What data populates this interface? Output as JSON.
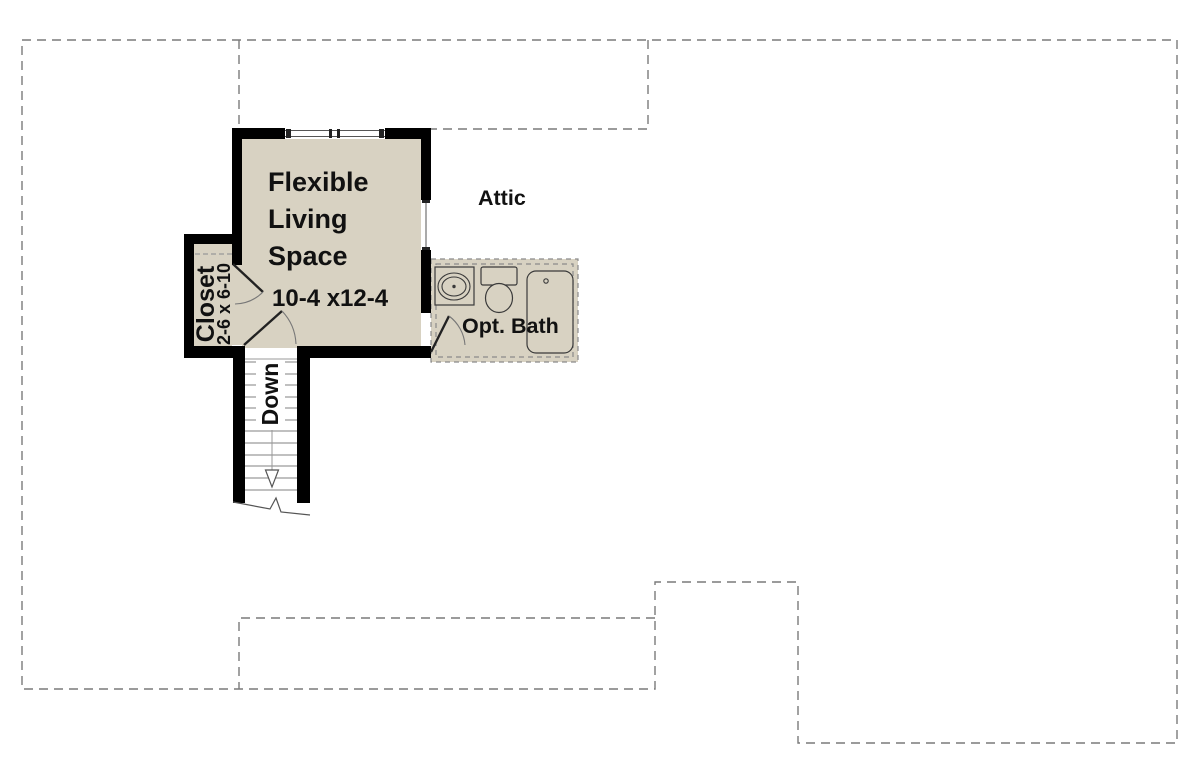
{
  "plan": {
    "type": "floor-plan",
    "labels": {
      "room_line1": "Flexible",
      "room_line2": "Living",
      "room_line3": "Space",
      "room_dims": "10-4 x12-4",
      "attic": "Attic",
      "bath": "Opt. Bath",
      "closet": "Closet",
      "closet_dims": "2-6 x 6-10",
      "stairs": "Down"
    },
    "rooms": [
      {
        "name": "Flexible Living Space",
        "dimensions": "10-4 x12-4"
      },
      {
        "name": "Attic"
      },
      {
        "name": "Opt. Bath"
      },
      {
        "name": "Closet",
        "dimensions": "2-6 x 6-10"
      },
      {
        "name": "Stairs",
        "direction": "Down"
      }
    ],
    "colors": {
      "floor_fill": "#d8d2c2",
      "wall": "#000000",
      "dashed_line": "#7a7a7a",
      "fixture_line": "#3a3a3a",
      "tread_line": "#9a9a9a",
      "text": "#111111",
      "background": "#ffffff"
    }
  }
}
